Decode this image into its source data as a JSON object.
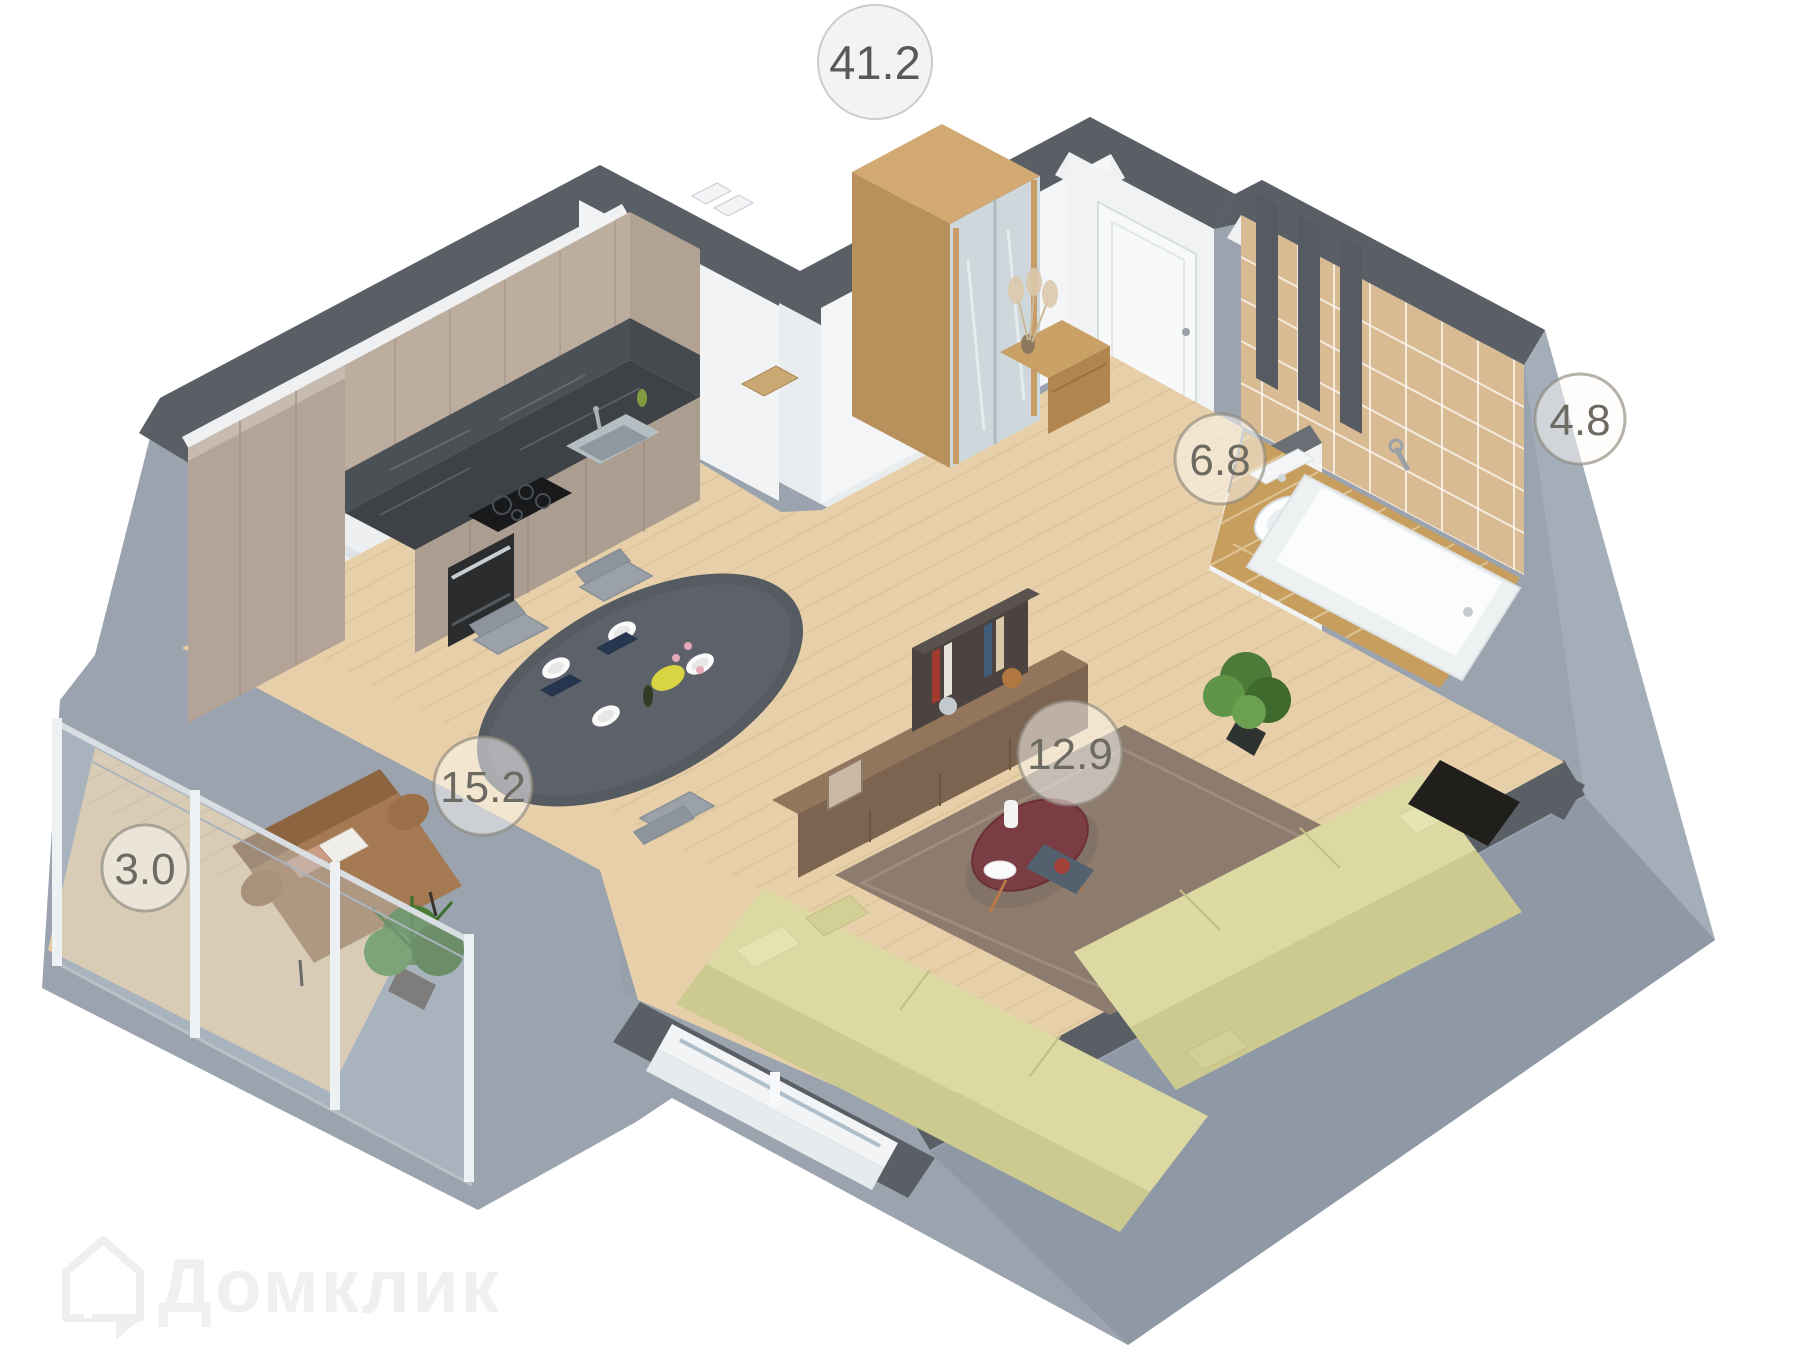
{
  "total_area_badge": {
    "value": "41.2"
  },
  "rooms": [
    {
      "id": "kitchen-dining",
      "area": "15.2"
    },
    {
      "id": "living-room",
      "area": "12.9"
    },
    {
      "id": "hallway",
      "area": "6.8"
    },
    {
      "id": "bathroom",
      "area": "4.8"
    },
    {
      "id": "balcony",
      "area": "3.0"
    }
  ],
  "watermark": {
    "brand": "Домклик"
  },
  "colors": {
    "wall_top": "#5a5f66",
    "wall_face_outer": "#9aa3ae",
    "floor_wood": "#e7d0a9",
    "bath_tile_wall": "#d9bb93",
    "bath_tile_floor": "#c89e5e",
    "sofa_olive": "#dcd9a2",
    "badge_ring": "#8d887c"
  }
}
